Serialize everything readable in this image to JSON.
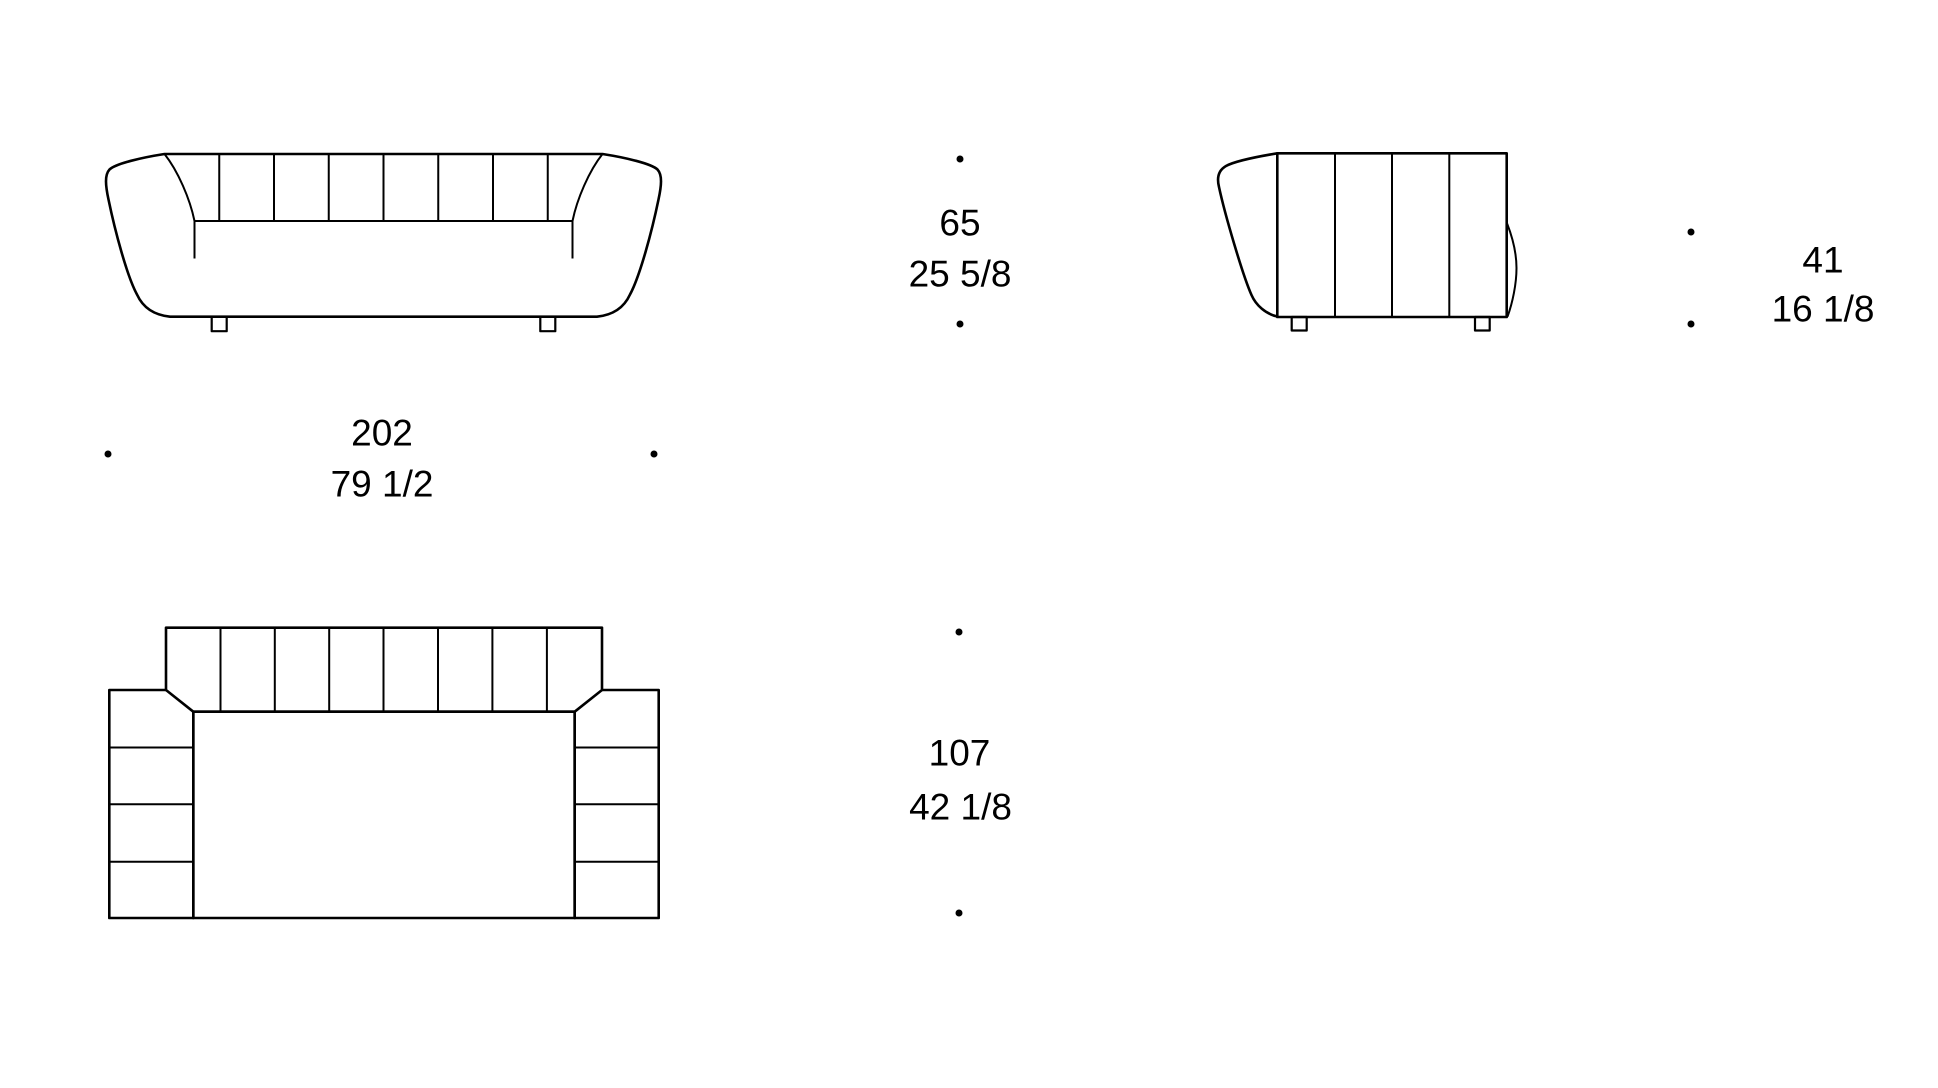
{
  "drawing": {
    "title": "sofa-dimension-drawing",
    "colors": {
      "line": "#000000",
      "background": "#ffffff",
      "text": "#000000"
    },
    "views": [
      {
        "id": "front",
        "label": "front-elevation"
      },
      {
        "id": "side",
        "label": "side-elevation"
      },
      {
        "id": "top",
        "label": "plan-view"
      }
    ],
    "dimensions": {
      "overall_height": {
        "cm": "65",
        "inches": "25 5/8"
      },
      "seat_height": {
        "cm": "41",
        "inches": "16 1/8"
      },
      "overall_width": {
        "cm": "202",
        "inches": "79 1/2"
      },
      "overall_depth": {
        "cm": "107",
        "inches": "42 1/8"
      }
    }
  }
}
